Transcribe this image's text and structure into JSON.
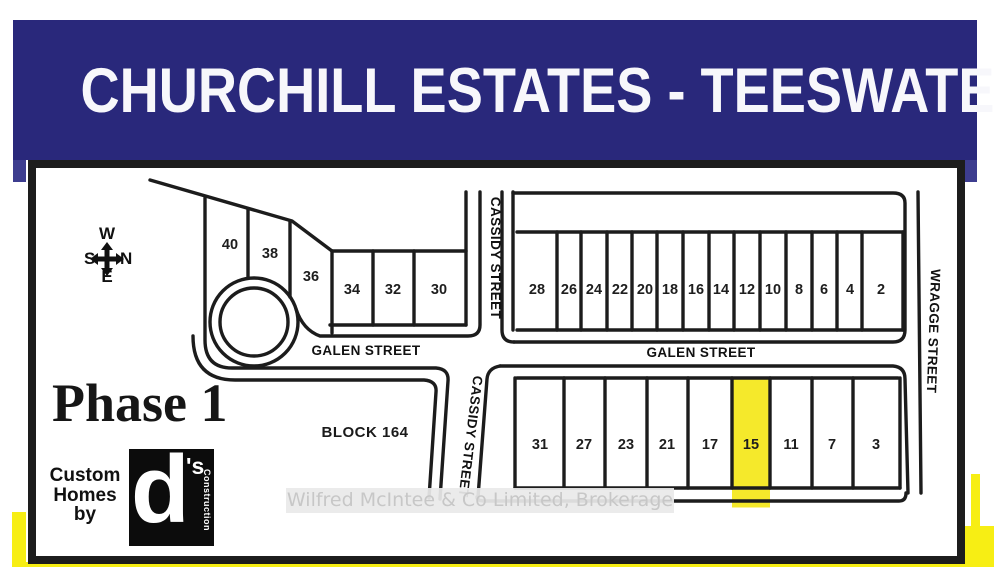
{
  "title": "CHURCHILL ESTATES - TEESWATER",
  "compass": {
    "top": "W",
    "left": "S",
    "right": "N",
    "bottom": "E"
  },
  "phase_label": "Phase 1",
  "block_label": "BLOCK 164",
  "builder": {
    "line1": "Custom",
    "line2": "Homes",
    "line3": "by",
    "logo_d": "d",
    "logo_s": "'s",
    "logo_side": "Construction"
  },
  "streets": {
    "galen_west": "GALEN STREET",
    "galen_east": "GALEN STREET",
    "cassidy_upper": "CASSIDY STREET",
    "cassidy_lower": "CASSIDY STREET",
    "wragge": "WRAGGE STREET"
  },
  "lots": {
    "northwest": [
      40,
      38,
      36,
      34,
      32,
      30
    ],
    "northeast": [
      28,
      26,
      24,
      22,
      20,
      18,
      16,
      14,
      12,
      10,
      8,
      6,
      4,
      2
    ],
    "south": [
      31,
      27,
      23,
      21,
      17,
      15,
      11,
      7,
      3
    ],
    "highlighted_lot": 15
  },
  "watermark": "Wilfred McIntee & Co Limited, Brokerage",
  "colors": {
    "banner_navy": "#29287b",
    "map_line": "#1c1c1c",
    "highlight_yellow": "#f5e92b",
    "frame_yellow": "#f7ee14",
    "watermark_gray": "#c7c7c7"
  }
}
